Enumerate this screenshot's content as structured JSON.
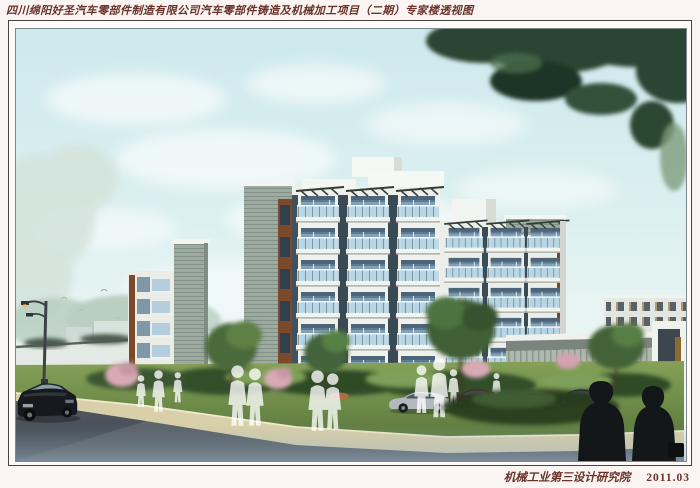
{
  "sheet": {
    "title": "四川绵阳好圣汽车零部件制造有限公司汽车零部件铸造及机械加工项目（二期）专家楼透视图",
    "footer": {
      "institute": "机械工业第三设计研究院",
      "date": "2011.03"
    }
  },
  "colors": {
    "title_text": "#6a332a",
    "sky_top": "#cde9ed",
    "foliage_dark": "#2b4530",
    "facade_white": "#eef0eb",
    "balcony_glass": "#bcd9e8",
    "window_glass": "#7fa2b8",
    "wood_panel": "#7c4a2a",
    "metal_cladding": "#9dab9f",
    "grass": "#6c8a4a",
    "sidewalk": "#d9d0aa",
    "road": "#575f66"
  }
}
